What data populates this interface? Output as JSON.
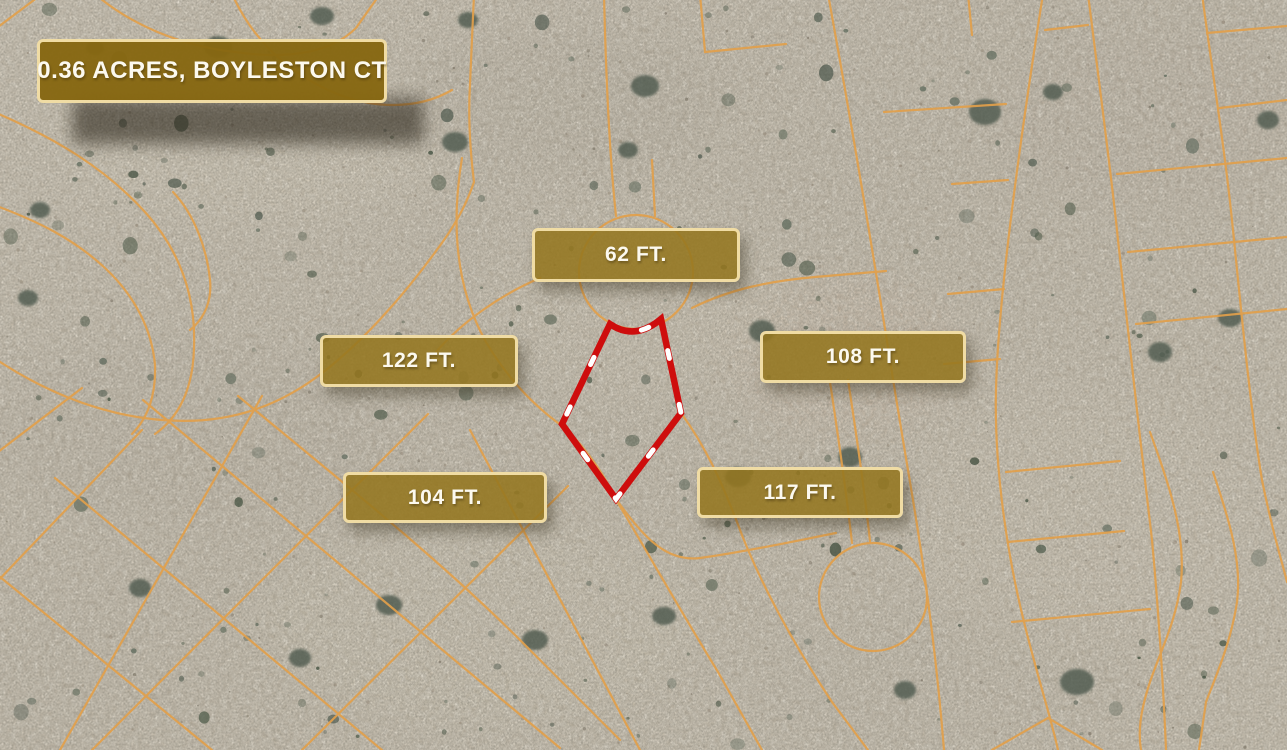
{
  "graphic": {
    "description": "Aerial satellite land-listing graphic with lot dimension labels"
  },
  "title_badge": {
    "label": "0.36 ACRES, BOYLESTON CT"
  },
  "measurements": [
    {
      "position": "top",
      "label": "62 FT."
    },
    {
      "position": "middle-left",
      "label": "122 FT."
    },
    {
      "position": "middle-right",
      "label": "108 FT."
    },
    {
      "position": "bottom-left",
      "label": "104 FT."
    },
    {
      "position": "bottom-right",
      "label": "117 FT."
    }
  ],
  "parcel": {
    "outline_path": "M 610,324 Q 635,341 661,319 L 681,413 L 616,499 L 562,424 Z",
    "outline_color": "#ce0d0d",
    "dash_color": "#ffffff"
  },
  "map": {
    "imagery": "desert satellite photo",
    "road_line_color": "#e2a04b",
    "sand_color": "#bdb2a0",
    "shrub_color": "#52604f",
    "label_bg_color": "#94761f",
    "label_border_color": "#f0dca4"
  }
}
